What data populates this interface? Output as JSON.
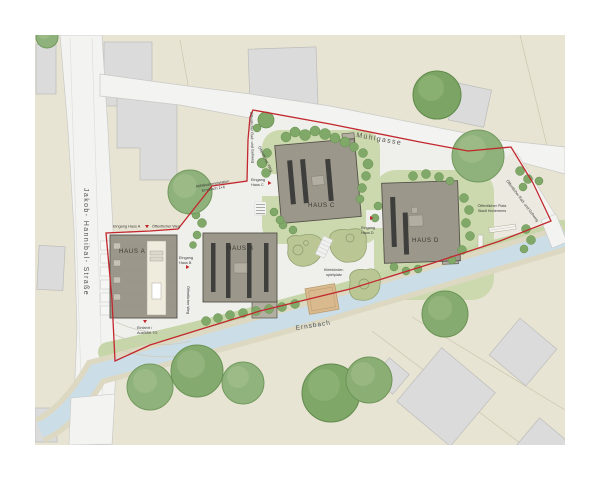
{
  "plan": {
    "streets": {
      "jakob_hannibal": "Jakob- Hannibal- Straße",
      "muehlgasse": "Mühlgasse",
      "ernsbach": "Ernsbach"
    },
    "buildings": {
      "haus_a": "HAUS A",
      "haus_b": "HAUS B",
      "haus_c": "HAUS C",
      "haus_d": "HAUS D"
    },
    "entrances": {
      "a_label": "Eingang Haus A",
      "a_weg": "Öffentlicher Weg",
      "b1": "Eingang",
      "b2": "Haus B",
      "c1": "Eingang",
      "c2": "Haus C",
      "d1": "Eingang",
      "d2": "Haus D"
    },
    "annotations": {
      "einfahrt1": "Einfahrt /",
      "einfahrt2": "Ausfahrt TG",
      "abfall1": "Abfallsammelstation",
      "abfall2": "Ernsbach 1+6",
      "weg_sued": "Öffentlicher Weg",
      "weg_nord": "Öffentlicher Weg",
      "radweg_nw": "Öffentlicher Rad- und Gehweg",
      "radweg_ost": "Öffentlicher Rad- und Gehweg",
      "platz1": "Öffentlicher Platz",
      "platz2": "Stadt Hohenems",
      "spielplatz1": "Kleinkinder-",
      "spielplatz2": "spielplatz"
    },
    "colors": {
      "boundary": "#c2272d",
      "new_building": "#9b978b",
      "roof_stripe": "#3e3e3c",
      "existing_building": "#dadbda",
      "parcel": "#e8e4d3",
      "street": "#f3f3f1",
      "paving": "#eff0ec",
      "water": "#cbdde7",
      "bank": "#ddd8c2",
      "lawn": "#ccd9ae",
      "tree": "#8fb17b",
      "playground": "#bac795",
      "sand": "#d9b98e"
    }
  }
}
